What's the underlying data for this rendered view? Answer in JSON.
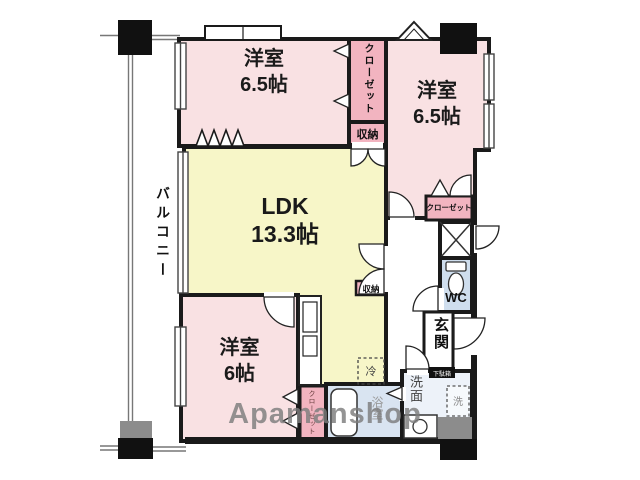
{
  "watermark": "Apamanshop",
  "colors": {
    "room_pink": "#f9e1e3",
    "closet_pink": "#f2b4c0",
    "ldk_yellow": "#f7f6c8",
    "wc_blue": "#cfdeee",
    "bath_blue": "#d9e4f1",
    "washroom_blue": "#edf2f9",
    "wall_black": "#1a1a1a",
    "pillar_gray": "#8c8c8c",
    "watermark_gray": "#8f8f8f"
  },
  "balcony": {
    "label": "バルコニー"
  },
  "rooms": {
    "bedroom_top_left": {
      "label": "洋室",
      "size": "6.5帖"
    },
    "bedroom_top_right": {
      "label": "洋室",
      "size": "6.5帖"
    },
    "ldk": {
      "label": "LDK",
      "size": "13.3帖"
    },
    "bedroom_bottom_left": {
      "label": "洋室",
      "size": "6帖"
    }
  },
  "features": {
    "closet_top": {
      "label": "クローゼット"
    },
    "storage_top": {
      "label": "収納"
    },
    "closet_right": {
      "label": "クローゼット"
    },
    "storage_mid": {
      "label": "収納"
    },
    "toilet": {
      "label": "WC"
    },
    "entrance": {
      "label": "玄関"
    },
    "shoe_cabinet": {
      "label": "下駄箱"
    },
    "washroom": {
      "label": "洗面"
    },
    "washer_space": {
      "label": "洗"
    },
    "refrigerator_space": {
      "label": "冷"
    },
    "bathroom": {
      "label": "浴室"
    },
    "closet_bottom": {
      "label": "クローゼット"
    }
  }
}
